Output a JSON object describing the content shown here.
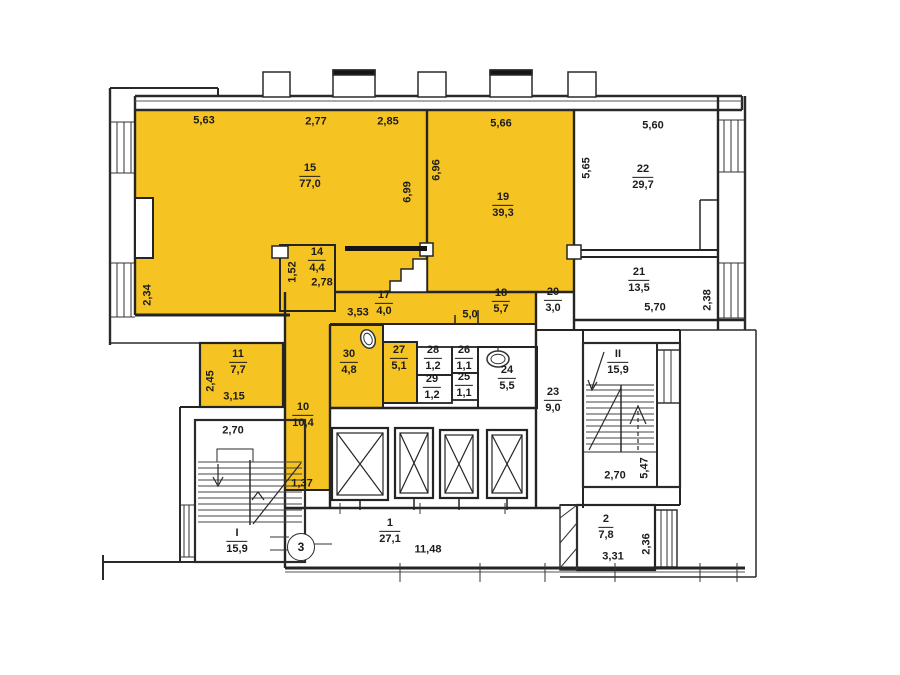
{
  "title": "apartment-floor-plan",
  "colors": {
    "highlight": "#F5C422",
    "wall": "#2a2a2a",
    "thin_line": "#555555"
  },
  "marker3": "3",
  "rooms": {
    "r1": {
      "number": "1",
      "area": "27,1"
    },
    "r2": {
      "number": "2",
      "area": "7,8"
    },
    "r10": {
      "number": "10",
      "area": "10,4"
    },
    "r11": {
      "number": "11",
      "area": "7,7"
    },
    "r14": {
      "number": "14",
      "area": "4,4"
    },
    "r15": {
      "number": "15",
      "area": "77,0"
    },
    "r17": {
      "number": "17",
      "area": "4,0"
    },
    "r18": {
      "number": "18",
      "area": "5,7"
    },
    "r19": {
      "number": "19",
      "area": "39,3"
    },
    "r20": {
      "number": "20",
      "area": "3,0"
    },
    "r21": {
      "number": "21",
      "area": "13,5"
    },
    "r22": {
      "number": "22",
      "area": "29,7"
    },
    "r23": {
      "number": "23",
      "area": "9,0"
    },
    "r24": {
      "number": "24",
      "area": "5,5"
    },
    "r25": {
      "number": "25",
      "area": "1,1"
    },
    "r26": {
      "number": "26",
      "area": "1,1"
    },
    "r27": {
      "number": "27",
      "area": "5,1"
    },
    "r28": {
      "number": "28",
      "area": "1,2"
    },
    "r29": {
      "number": "29",
      "area": "1,2"
    },
    "r30": {
      "number": "30",
      "area": "4,8"
    },
    "stair1": {
      "number": "I",
      "area": "15,9"
    },
    "stair2": {
      "number": "II",
      "area": "15,9"
    }
  },
  "dims": {
    "d563": "5,63",
    "d277": "2,77",
    "d285": "2,85",
    "d566": "5,66",
    "d560": "5,60",
    "d699": "6,99",
    "d696": "6,96",
    "d565": "5,65",
    "d234": "2,34",
    "d152": "1,52",
    "d278": "2,78",
    "d353": "3,53",
    "d50": "5,0",
    "d570": "5,70",
    "d238": "2,38",
    "d245": "2,45",
    "d315": "3,15",
    "d270a": "2,70",
    "d137": "1,37",
    "d1148": "11,48",
    "d270b": "2,70",
    "d547": "5,47",
    "d331": "3,31",
    "d236": "2,36"
  }
}
